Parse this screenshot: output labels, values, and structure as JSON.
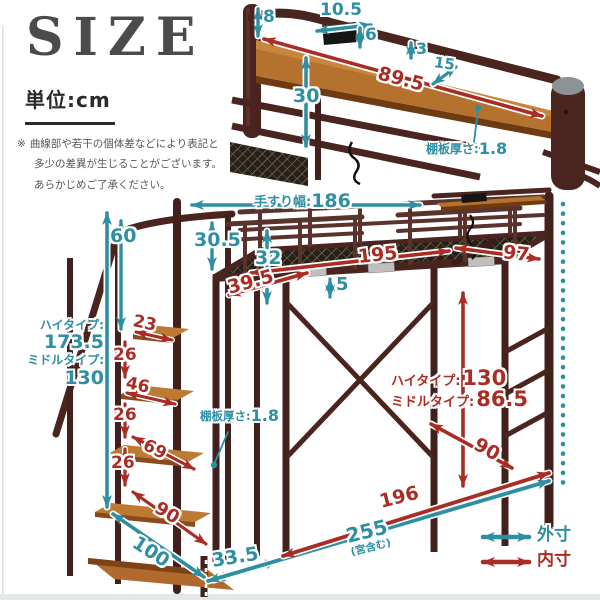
{
  "header": {
    "title": "SIZE",
    "unit_label": "単位:cm",
    "note": {
      "marker": "※",
      "line1": "曲線部や若干の個体差などにより表記と",
      "line2": "多少の差異が生じることがございます。",
      "line3": "あらかじめご了承ください。"
    }
  },
  "colors": {
    "outer_teal": "#2E8FA3",
    "inner_red": "#A92C25"
  },
  "top_inset": {
    "post_height": "8",
    "outlet_width": "10.5",
    "outlet_height": "6",
    "rail_gap": "3",
    "shelf_length": "89.5",
    "shelf_depth": "15",
    "headboard_height": "30",
    "shelf_thickness_label": "棚板厚さ:",
    "shelf_thickness_value": "1.8"
  },
  "main": {
    "handrail_label": "手すり幅:",
    "handrail_value": "186",
    "rail_to_step": "60",
    "high_type_label": "ハイタイプ:",
    "high_type_value": "173.5",
    "middle_type_label": "ミドルタイプ:",
    "middle_type_value": "130",
    "guard_front_height": "30.5",
    "guard_height": "32",
    "inner_length": "195",
    "inner_right": "97",
    "deck_inset": "39.5",
    "frame_lip": "5",
    "under_high_label": "ハイタイプ:",
    "under_high_value": "130",
    "under_middle_label": "ミドルタイプ:",
    "under_middle_value": "86.5",
    "under_depth": "90",
    "step1_depth": "23",
    "step_gap1": "26",
    "step2_depth": "46",
    "step_gap2": "26",
    "step3_depth": "69",
    "step_gap3": "26",
    "step4_depth": "90",
    "stair_depth": "100",
    "end_offset": "33.5",
    "shelf_thickness_label": "棚板厚さ:",
    "shelf_thickness_value": "1.8",
    "frame_length": "196",
    "total_length": "255",
    "total_note": "(宮含む)"
  },
  "legend": {
    "outer": "外寸",
    "inner": "内寸"
  }
}
